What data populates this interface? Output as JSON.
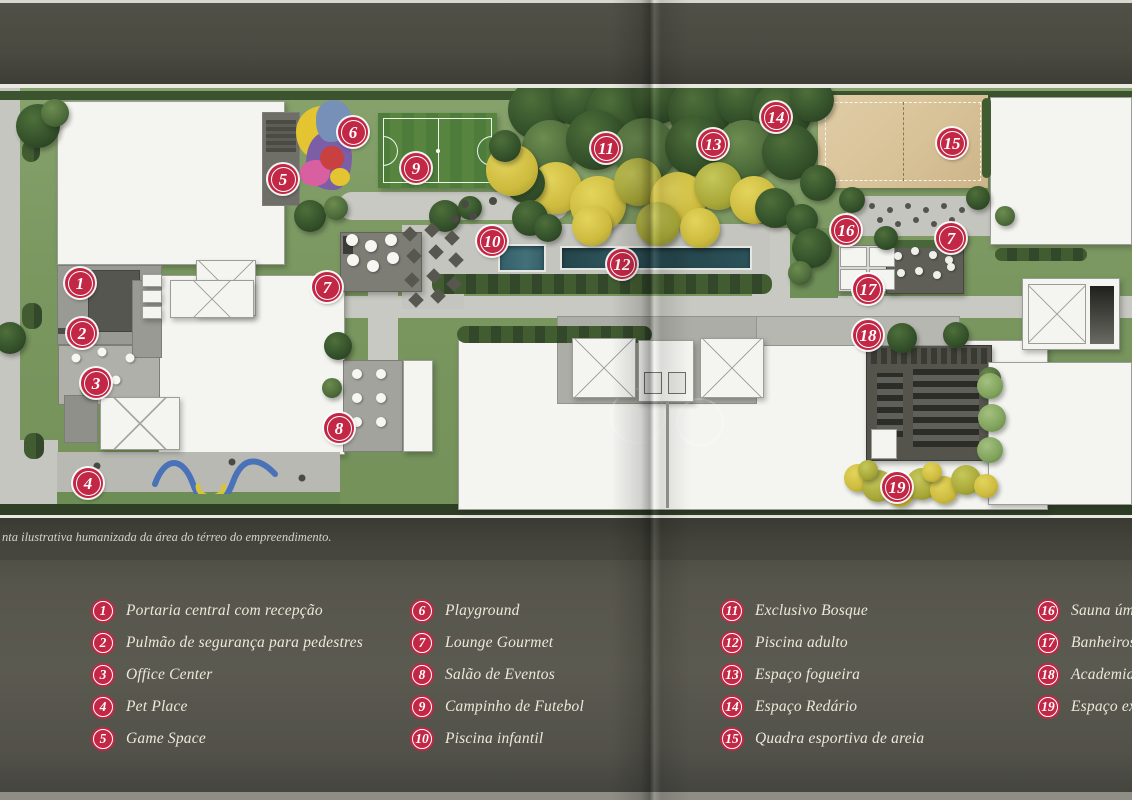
{
  "page": {
    "caption": "nta ilustrativa humanizada da área do térreo do empreendimento."
  },
  "colors": {
    "page-bg": "#4c4c43",
    "legend-text": "#ece9db",
    "marker-red": "#c22745",
    "path": "#c9c9c3",
    "building": "#f4f4f1",
    "pool": "#2a4b51",
    "sand": "#dcc79e",
    "field-green": "#4e7c3b"
  },
  "map": {
    "markers": [
      {
        "n": "1",
        "x": 80,
        "y": 283
      },
      {
        "n": "2",
        "x": 82,
        "y": 333
      },
      {
        "n": "3",
        "x": 96,
        "y": 383
      },
      {
        "n": "4",
        "x": 88,
        "y": 483
      },
      {
        "n": "5",
        "x": 283,
        "y": 179
      },
      {
        "n": "6",
        "x": 353,
        "y": 132
      },
      {
        "n": "7",
        "x": 327,
        "y": 287
      },
      {
        "n": "8",
        "x": 339,
        "y": 428
      },
      {
        "n": "9",
        "x": 416,
        "y": 168
      },
      {
        "n": "10",
        "x": 492,
        "y": 241
      },
      {
        "n": "11",
        "x": 606,
        "y": 148
      },
      {
        "n": "12",
        "x": 622,
        "y": 264
      },
      {
        "n": "13",
        "x": 713,
        "y": 144
      },
      {
        "n": "14",
        "x": 776,
        "y": 117
      },
      {
        "n": "15",
        "x": 952,
        "y": 143
      },
      {
        "n": "16",
        "x": 846,
        "y": 230
      },
      {
        "n": "7",
        "x": 951,
        "y": 238
      },
      {
        "n": "17",
        "x": 868,
        "y": 289
      },
      {
        "n": "18",
        "x": 868,
        "y": 335
      },
      {
        "n": "19",
        "x": 897,
        "y": 487
      }
    ]
  },
  "legend": {
    "columns": [
      {
        "items": [
          {
            "n": "1",
            "label": "Portaria central com recepção"
          },
          {
            "n": "2",
            "label": "Pulmão de segurança para pedestres"
          },
          {
            "n": "3",
            "label": "Office Center"
          },
          {
            "n": "4",
            "label": "Pet Place"
          },
          {
            "n": "5",
            "label": "Game Space"
          }
        ]
      },
      {
        "items": [
          {
            "n": "6",
            "label": "Playground"
          },
          {
            "n": "7",
            "label": "Lounge Gourmet"
          },
          {
            "n": "8",
            "label": "Salão de Eventos"
          },
          {
            "n": "9",
            "label": "Campinho de Futebol"
          },
          {
            "n": "10",
            "label": "Piscina infantil"
          }
        ]
      },
      {
        "items": [
          {
            "n": "11",
            "label": "Exclusivo Bosque"
          },
          {
            "n": "12",
            "label": "Piscina adulto"
          },
          {
            "n": "13",
            "label": "Espaço fogueira"
          },
          {
            "n": "14",
            "label": "Espaço Redário"
          },
          {
            "n": "15",
            "label": "Quadra esportiva de areia"
          }
        ]
      },
      {
        "items": [
          {
            "n": "16",
            "label": "Sauna úmida"
          },
          {
            "n": "17",
            "label": "Banheiros exte"
          },
          {
            "n": "18",
            "label": "Academia"
          },
          {
            "n": "19",
            "label": "Espaço extern"
          }
        ]
      }
    ]
  }
}
